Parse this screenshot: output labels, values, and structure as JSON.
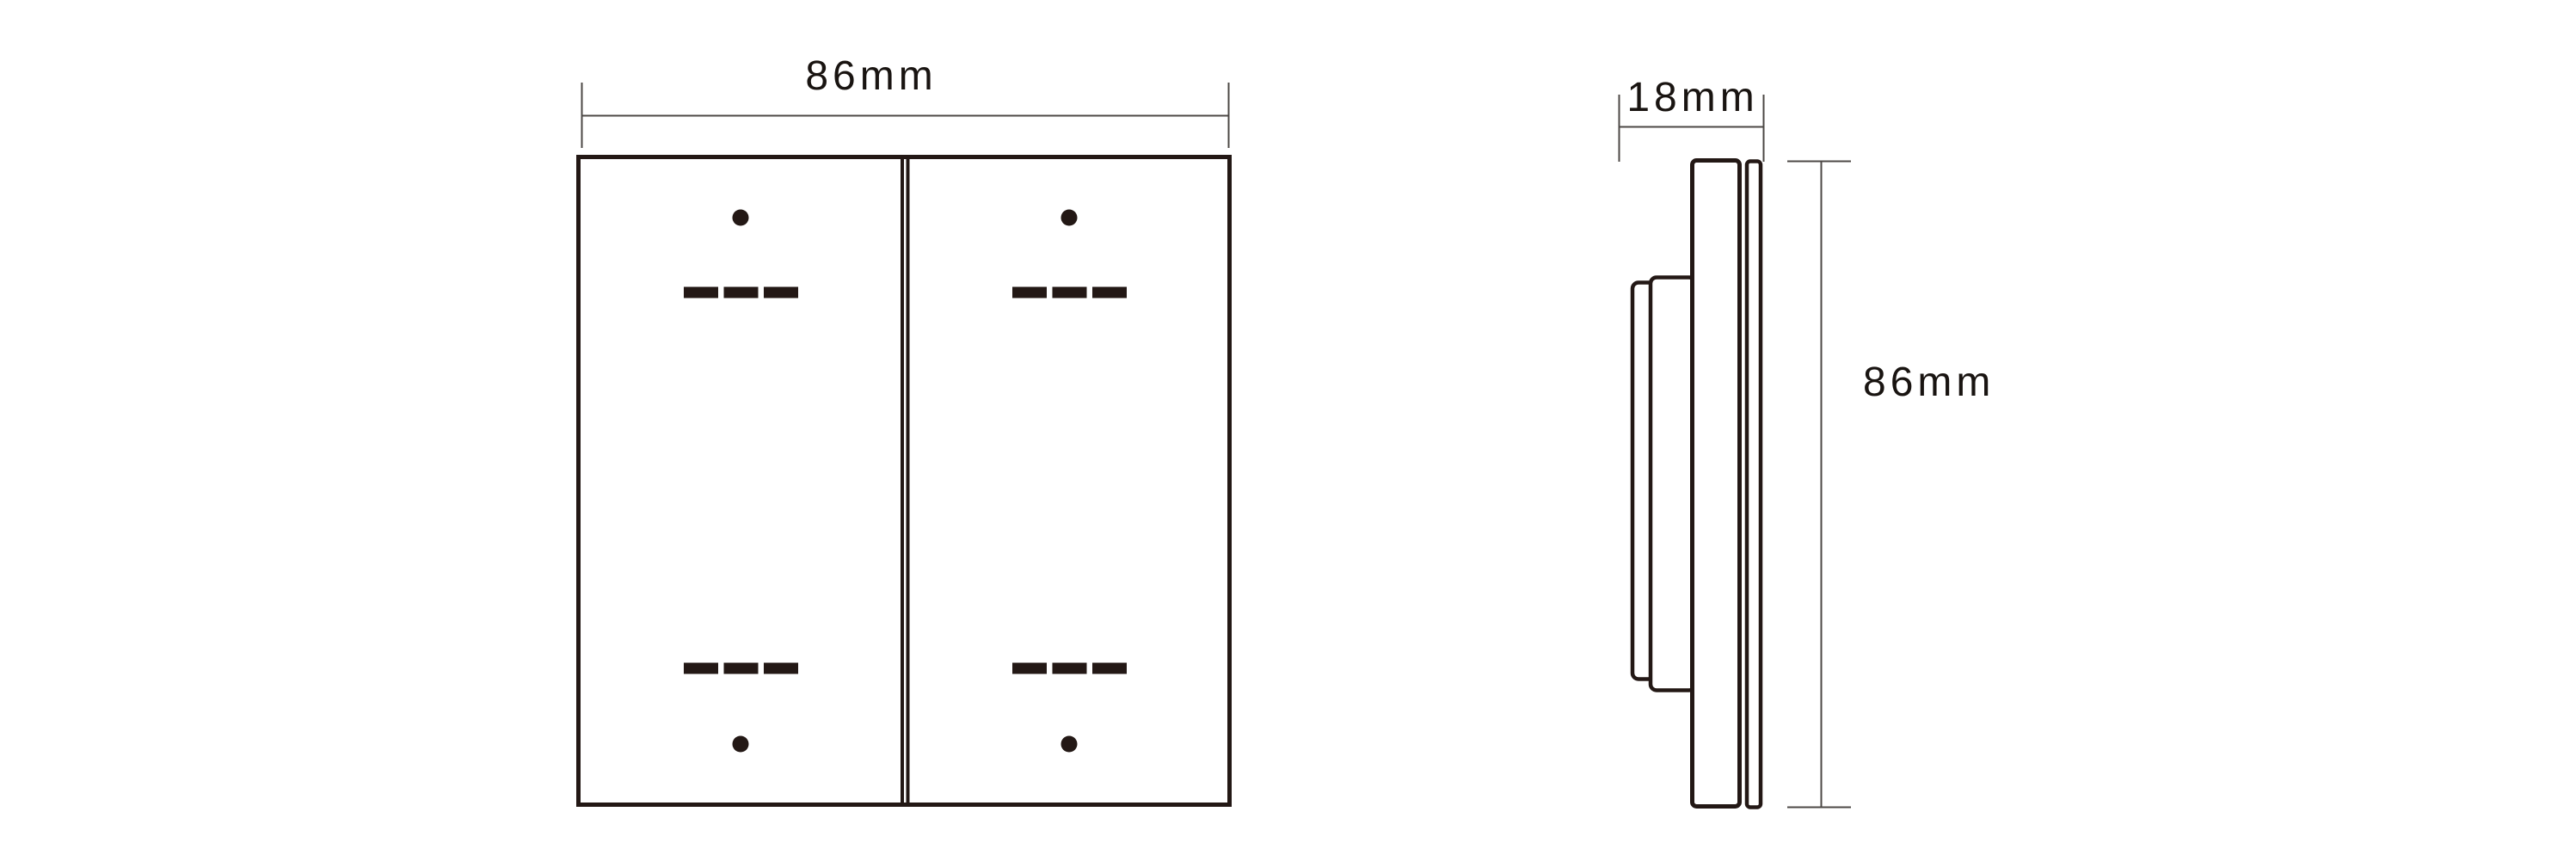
{
  "background_color": "#ffffff",
  "line_colors": {
    "drawing_outline": "#231815",
    "dimension_lines": "#4c4845",
    "label_text": "#191411"
  },
  "front_view": {
    "description": "front view of 2-gang rocker switch panel",
    "width_dimension_label": "86mm",
    "rocker_count": 2,
    "rocker_marks": {
      "top_marks": [
        "dot",
        "triple-dash-row"
      ],
      "bottom_marks": [
        "triple-dash-row",
        "dot"
      ],
      "dashes_per_row": 3
    }
  },
  "side_view": {
    "description": "side profile with front plate and stepped rear mounting box",
    "depth_dimension_label": "18mm",
    "height_dimension_label": "86mm"
  }
}
